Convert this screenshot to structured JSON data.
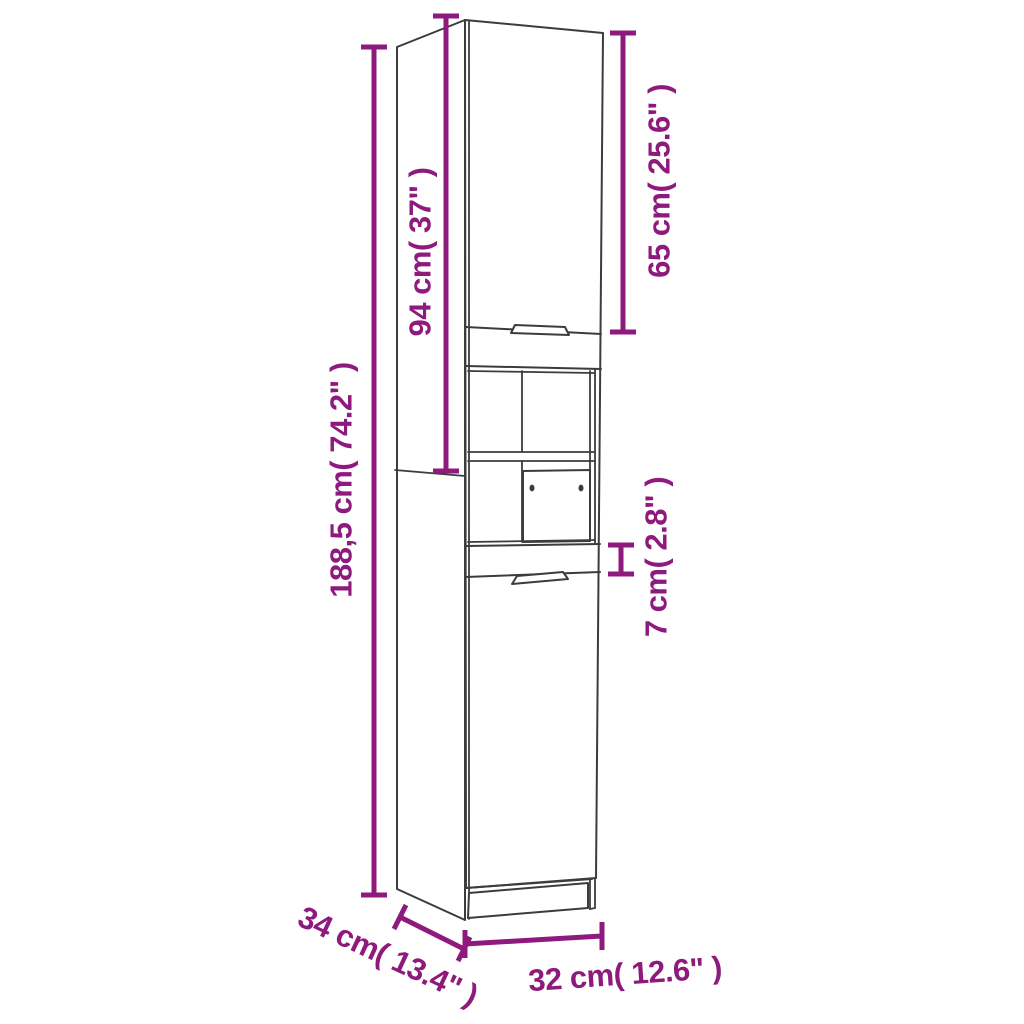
{
  "diagram": {
    "kind": "furniture-dimension-diagram",
    "subject": "tall narrow cabinet with two doors, open shelves and small double-knob door",
    "colors": {
      "accent": "#8e1a7d",
      "line": "#3c3c3c",
      "background": "#ffffff"
    },
    "labels": {
      "overall_height": "188,5 cm( 74.2\" )",
      "upper_section_height": "94 cm( 37\" )",
      "upper_door_height": "65 cm( 25.6\" )",
      "rail_height": "7 cm( 2.8\" )",
      "depth": "34 cm( 13.4\" )",
      "width": "32 cm( 12.6\" )"
    }
  }
}
